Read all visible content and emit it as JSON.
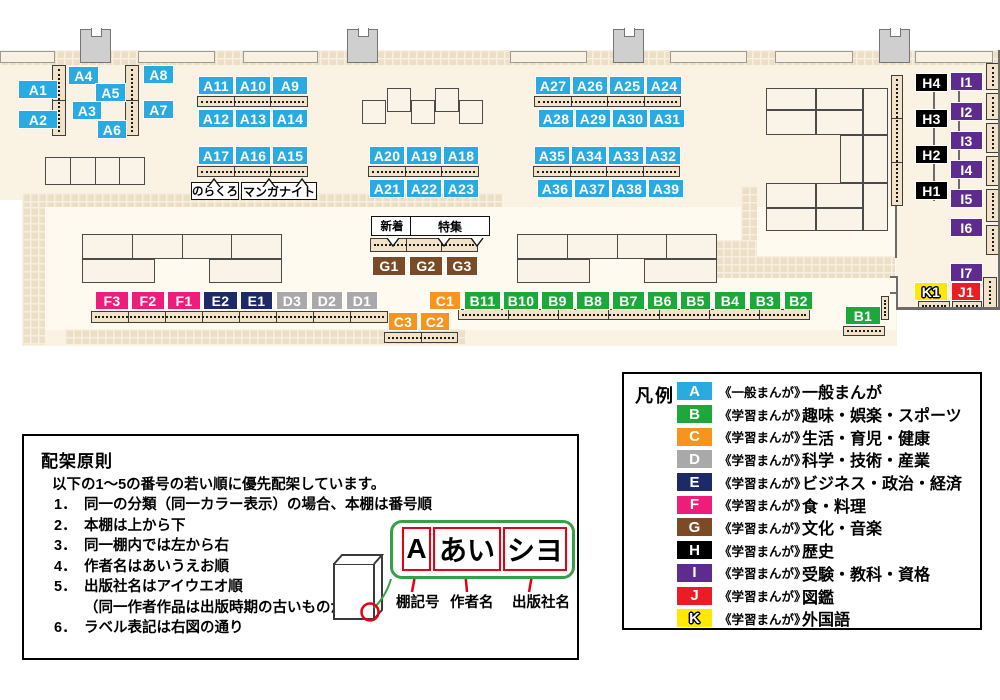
{
  "colors": {
    "A": "#29abe2",
    "B": "#1ea83c",
    "C": "#f7941d",
    "D": "#a9a9a9",
    "E": "#1e2a68",
    "F": "#ec1e79",
    "G": "#7b4a26",
    "H": "#000000",
    "I": "#5e2c8e",
    "J": "#ec1c24",
    "K": "#ffe900"
  },
  "map": {
    "shelf_labels": [
      {
        "t": "A1",
        "x": 18,
        "y": 80,
        "w": 40
      },
      {
        "t": "A4",
        "x": 68,
        "y": 66,
        "w": 31
      },
      {
        "t": "A8",
        "x": 143,
        "y": 65,
        "w": 31
      },
      {
        "t": "A5",
        "x": 95,
        "y": 83,
        "w": 31
      },
      {
        "t": "A3",
        "x": 72,
        "y": 101,
        "w": 30
      },
      {
        "t": "A7",
        "x": 143,
        "y": 100,
        "w": 31
      },
      {
        "t": "A2",
        "x": 18,
        "y": 110,
        "w": 40
      },
      {
        "t": "A6",
        "x": 97,
        "y": 120,
        "w": 30
      },
      {
        "t": "A11",
        "x": 198,
        "y": 76,
        "w": 36
      },
      {
        "t": "A10",
        "x": 235,
        "y": 76,
        "w": 36
      },
      {
        "t": "A9",
        "x": 272,
        "y": 76,
        "w": 36
      },
      {
        "t": "A12",
        "x": 198,
        "y": 109,
        "w": 36
      },
      {
        "t": "A13",
        "x": 235,
        "y": 109,
        "w": 36
      },
      {
        "t": "A14",
        "x": 272,
        "y": 109,
        "w": 36
      },
      {
        "t": "A17",
        "x": 198,
        "y": 146,
        "w": 36
      },
      {
        "t": "A16",
        "x": 235,
        "y": 146,
        "w": 36
      },
      {
        "t": "A15",
        "x": 272,
        "y": 146,
        "w": 36
      },
      {
        "t": "A20",
        "x": 369,
        "y": 146,
        "w": 36
      },
      {
        "t": "A19",
        "x": 406,
        "y": 146,
        "w": 36
      },
      {
        "t": "A18",
        "x": 443,
        "y": 146,
        "w": 36
      },
      {
        "t": "A21",
        "x": 369,
        "y": 179,
        "w": 36
      },
      {
        "t": "A22",
        "x": 406,
        "y": 179,
        "w": 36
      },
      {
        "t": "A23",
        "x": 443,
        "y": 179,
        "w": 36
      },
      {
        "t": "A27",
        "x": 535,
        "y": 76,
        "w": 36
      },
      {
        "t": "A26",
        "x": 572,
        "y": 76,
        "w": 36
      },
      {
        "t": "A25",
        "x": 609,
        "y": 76,
        "w": 36
      },
      {
        "t": "A24",
        "x": 646,
        "y": 76,
        "w": 36
      },
      {
        "t": "A28",
        "x": 538,
        "y": 109,
        "w": 36
      },
      {
        "t": "A29",
        "x": 575,
        "y": 109,
        "w": 36
      },
      {
        "t": "A30",
        "x": 612,
        "y": 109,
        "w": 36
      },
      {
        "t": "A31",
        "x": 649,
        "y": 109,
        "w": 36
      },
      {
        "t": "A35",
        "x": 534,
        "y": 146,
        "w": 36
      },
      {
        "t": "A34",
        "x": 571,
        "y": 146,
        "w": 36
      },
      {
        "t": "A33",
        "x": 608,
        "y": 146,
        "w": 36
      },
      {
        "t": "A32",
        "x": 645,
        "y": 146,
        "w": 36
      },
      {
        "t": "A36",
        "x": 537,
        "y": 179,
        "w": 36
      },
      {
        "t": "A37",
        "x": 574,
        "y": 179,
        "w": 36
      },
      {
        "t": "A38",
        "x": 611,
        "y": 179,
        "w": 36
      },
      {
        "t": "A39",
        "x": 648,
        "y": 179,
        "w": 36
      },
      {
        "t": "G1",
        "x": 372,
        "y": 256,
        "w": 34,
        "h": 20
      },
      {
        "t": "G2",
        "x": 409,
        "y": 256,
        "w": 34,
        "h": 20
      },
      {
        "t": "G3",
        "x": 446,
        "y": 256,
        "w": 32,
        "h": 20
      },
      {
        "t": "H4",
        "x": 915,
        "y": 73,
        "w": 33
      },
      {
        "t": "H3",
        "x": 915,
        "y": 109,
        "w": 33
      },
      {
        "t": "H2",
        "x": 915,
        "y": 145,
        "w": 33
      },
      {
        "t": "H1",
        "x": 915,
        "y": 181,
        "w": 33
      },
      {
        "t": "I1",
        "x": 950,
        "y": 72,
        "w": 33
      },
      {
        "t": "I2",
        "x": 950,
        "y": 102,
        "w": 33
      },
      {
        "t": "I3",
        "x": 950,
        "y": 131,
        "w": 33
      },
      {
        "t": "I4",
        "x": 950,
        "y": 160,
        "w": 33
      },
      {
        "t": "I5",
        "x": 950,
        "y": 189,
        "w": 33
      },
      {
        "t": "I6",
        "x": 950,
        "y": 218,
        "w": 33
      },
      {
        "t": "I7",
        "x": 950,
        "y": 263,
        "w": 33
      },
      {
        "t": "K1",
        "x": 914,
        "y": 282,
        "w": 34
      },
      {
        "t": "J1",
        "x": 951,
        "y": 282,
        "w": 30
      },
      {
        "t": "F3",
        "x": 95,
        "y": 291,
        "w": 34
      },
      {
        "t": "F2",
        "x": 131,
        "y": 291,
        "w": 34
      },
      {
        "t": "F1",
        "x": 167,
        "y": 291,
        "w": 34
      },
      {
        "t": "E2",
        "x": 203,
        "y": 291,
        "w": 35
      },
      {
        "t": "E1",
        "x": 240,
        "y": 291,
        "w": 33
      },
      {
        "t": "D3",
        "x": 276,
        "y": 291,
        "w": 32
      },
      {
        "t": "D2",
        "x": 311,
        "y": 291,
        "w": 32
      },
      {
        "t": "D1",
        "x": 346,
        "y": 291,
        "w": 32
      },
      {
        "t": "C1",
        "x": 429,
        "y": 291,
        "w": 32
      },
      {
        "t": "C3",
        "x": 388,
        "y": 312,
        "w": 30
      },
      {
        "t": "C2",
        "x": 420,
        "y": 312,
        "w": 30
      },
      {
        "t": "B11",
        "x": 464,
        "y": 291,
        "w": 37
      },
      {
        "t": "B10",
        "x": 503,
        "y": 291,
        "w": 36
      },
      {
        "t": "B9",
        "x": 541,
        "y": 291,
        "w": 33
      },
      {
        "t": "B8",
        "x": 576,
        "y": 291,
        "w": 34
      },
      {
        "t": "B7",
        "x": 612,
        "y": 291,
        "w": 33
      },
      {
        "t": "B6",
        "x": 647,
        "y": 291,
        "w": 31
      },
      {
        "t": "B5",
        "x": 680,
        "y": 291,
        "w": 31
      },
      {
        "t": "B4",
        "x": 714,
        "y": 291,
        "w": 32
      },
      {
        "t": "B3",
        "x": 749,
        "y": 291,
        "w": 32
      },
      {
        "t": "B2",
        "x": 784,
        "y": 291,
        "w": 29
      },
      {
        "t": "B1",
        "x": 845,
        "y": 306,
        "w": 36
      }
    ],
    "callouts": [
      {
        "text": "のらくろ",
        "x": 191,
        "y": 182,
        "w": 48,
        "h": 18
      },
      {
        "text": "マンガナイト",
        "x": 241,
        "y": 182,
        "w": 76,
        "h": 18
      },
      {
        "text": "新着",
        "x": 371,
        "y": 216,
        "w": 42,
        "h": 20
      },
      {
        "text": "特集",
        "x": 410,
        "y": 216,
        "w": 80,
        "h": 20
      }
    ]
  },
  "legend": {
    "title": "凡例",
    "items": [
      {
        "letter": "A",
        "series": "《一般まんが》",
        "category": "一般まんが"
      },
      {
        "letter": "B",
        "series": "《学習まんが》",
        "category": "趣味・娯楽・スポーツ"
      },
      {
        "letter": "C",
        "series": "《学習まんが》",
        "category": "生活・育児・健康"
      },
      {
        "letter": "D",
        "series": "《学習まんが》",
        "category": "科学・技術・産業"
      },
      {
        "letter": "E",
        "series": "《学習まんが》",
        "category": "ビジネス・政治・経済"
      },
      {
        "letter": "F",
        "series": "《学習まんが》",
        "category": "食・料理"
      },
      {
        "letter": "G",
        "series": "《学習まんが》",
        "category": "文化・音楽"
      },
      {
        "letter": "H",
        "series": "《学習まんが》",
        "category": "歴史"
      },
      {
        "letter": "I",
        "series": "《学習まんが》",
        "category": "受験・教科・資格"
      },
      {
        "letter": "J",
        "series": "《学習まんが》",
        "category": "図鑑"
      },
      {
        "letter": "K",
        "series": "《学習まんが》",
        "category": "外国語"
      }
    ]
  },
  "principles": {
    "title": "配架原則",
    "intro": "以下の1～5の番号の若い順に優先配架しています。",
    "rules": [
      {
        "num": "1．",
        "text": "同一の分類（同一カラー表示）の場合、本棚は番号順"
      },
      {
        "num": "2．",
        "text": "本棚は上から下"
      },
      {
        "num": "3．",
        "text": "同一棚内では左から右"
      },
      {
        "num": "4．",
        "text": "作者名はあいうえお順"
      },
      {
        "num": "5．",
        "text": "出版社名はアイウエオ順",
        "note": "（同一作者作品は出版時期の古いものが先）"
      },
      {
        "num": "6．",
        "text": "ラベル表記は右図の通り"
      }
    ],
    "label_diagram": {
      "boxes": [
        "A",
        "あい",
        "シヨ"
      ],
      "captions": [
        "棚記号",
        "作者名",
        "出版社名"
      ]
    }
  }
}
